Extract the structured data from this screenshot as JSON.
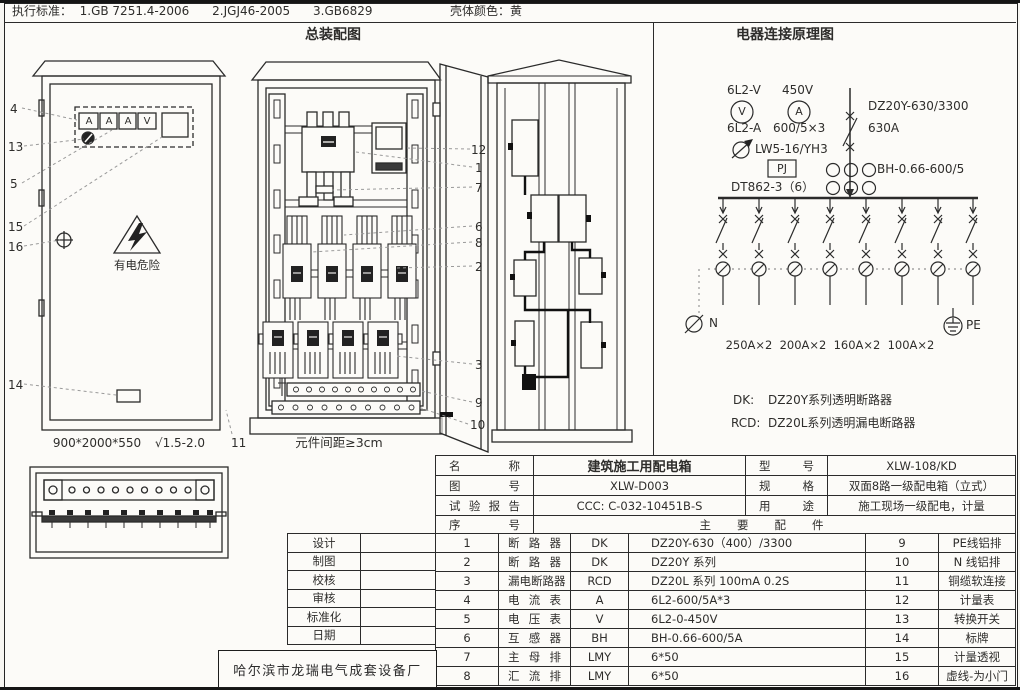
{
  "header": {
    "standards": "执行标准：  1.GB 7251.4-2006      2.JGJ46-2005      3.GB6829",
    "shell_color": "壳体颜色：黄"
  },
  "titles": {
    "assembly": "总装配图",
    "schematic": "电器连接原理图"
  },
  "assembly": {
    "meter_labels": [
      "A",
      "A",
      "A",
      "V"
    ],
    "warning": "有电危险",
    "left_cabinet_size": "900*2000*550",
    "left_cabinet_finish": "√1.5-2.0",
    "door_callout": "11",
    "middle_caption": "元件间距≥3cm",
    "left_callouts": [
      "4",
      "13",
      "5",
      "15",
      "16",
      "14"
    ],
    "middle_callouts": [
      "12",
      "1",
      "7",
      "6",
      "8",
      "2",
      "3",
      "9",
      "10"
    ]
  },
  "schematic": {
    "voltmeter_model": "6L2-V",
    "voltage": "450V",
    "voltmeter_symbol": "V",
    "ammeter_symbol": "A",
    "ammeter_model": "6L2-A",
    "ct_ratio": "600/5×3",
    "main_breaker_model": "DZ20Y-630/3300",
    "main_breaker_rating": "630A",
    "selector_model": "LW5-16/YH3",
    "pj_label": "PJ",
    "ct_model": "BH-0.66-600/5",
    "energy_meter_model": "DT862-3（6）",
    "neutral_label": "N",
    "pe_label": "PE",
    "branch_ratings": [
      "250A×2",
      "200A×2",
      "160A×2",
      "100A×2"
    ],
    "notes": [
      {
        "abbr": "DK:",
        "desc": "DZ20Y系列透明断路器"
      },
      {
        "abbr": "RCD:",
        "desc": "DZ20L系列透明漏电断路器"
      }
    ]
  },
  "info_table": {
    "rows": [
      {
        "k1": "名称",
        "v1": "建筑施工用配电箱",
        "k2": "型号",
        "v2": "XLW-108/KD"
      },
      {
        "k1": "图号",
        "v1": "XLW-D003",
        "k2": "规格",
        "v2": "双面8路一级配电箱（立式）"
      },
      {
        "k1": "试验报告",
        "v1": "CCC: C-032-10451B-S",
        "k2": "用途",
        "v2": "施工现场一级配电，计量"
      }
    ],
    "seq_label": "序号",
    "parts_label": "主要配件"
  },
  "parts": [
    {
      "no": "1",
      "name": "断路器",
      "code": "DK",
      "spec": "DZ20Y-630（400）/3300",
      "no2": "9",
      "name2": "PE线铝排"
    },
    {
      "no": "2",
      "name": "断路器",
      "code": "DK",
      "spec": "DZ20Y 系列",
      "no2": "10",
      "name2": "N 线铝排"
    },
    {
      "no": "3",
      "name": "漏电断路器",
      "code": "RCD",
      "spec": "DZ20L 系列  100mA 0.2S",
      "no2": "11",
      "name2": "铜缆软连接"
    },
    {
      "no": "4",
      "name": "电流表",
      "code": "A",
      "spec": "6L2-600/5A*3",
      "no2": "12",
      "name2": "计量表"
    },
    {
      "no": "5",
      "name": "电压表",
      "code": "V",
      "spec": "6L2-0-450V",
      "no2": "13",
      "name2": "转换开关"
    },
    {
      "no": "6",
      "name": "互感器",
      "code": "BH",
      "spec": "BH-0.66-600/5A",
      "no2": "14",
      "name2": "标牌"
    },
    {
      "no": "7",
      "name": "主母排",
      "code": "LMY",
      "spec": "6*50",
      "no2": "15",
      "name2": "计量透视"
    },
    {
      "no": "8",
      "name": "汇流排",
      "code": "LMY",
      "spec": "6*50",
      "no2": "16",
      "name2": "虚线-为小门"
    }
  ],
  "sign_table": [
    "设计",
    "制图",
    "校核",
    "审核",
    "标准化",
    "日期"
  ],
  "factory": "哈尔滨市龙瑞电气成套设备厂"
}
